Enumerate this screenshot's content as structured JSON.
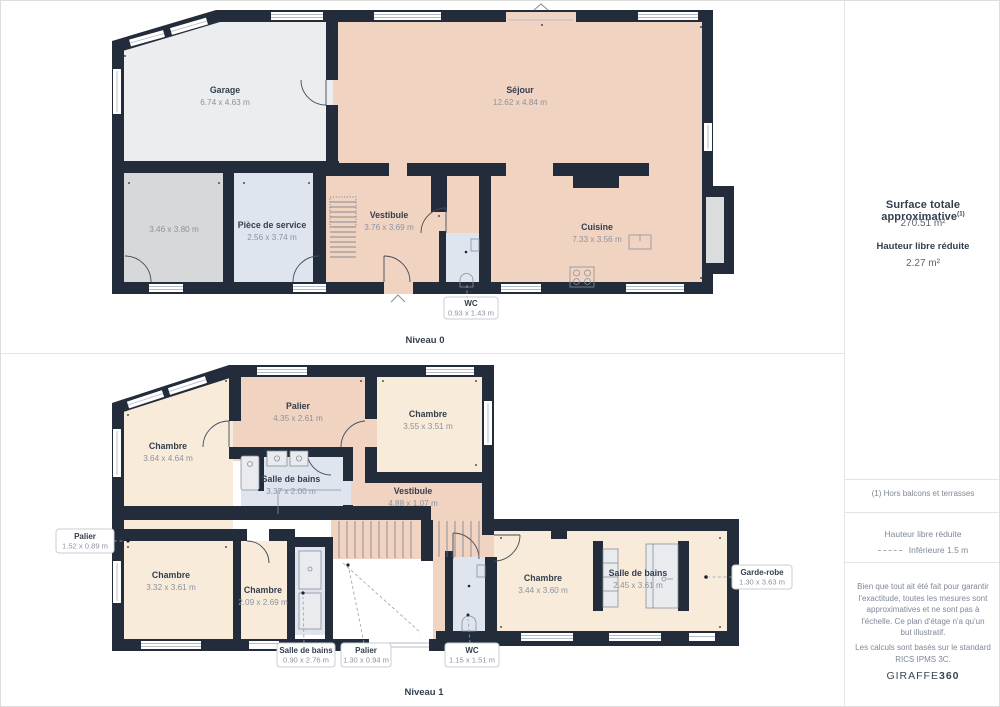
{
  "sidebar": {
    "surface_title": "Surface totale approximative",
    "surface_sup": "(1)",
    "surface_value": "270.51 m²",
    "height_title": "Hauteur libre réduite",
    "height_value": "2.27 m²",
    "footnote": "(1) Hors balcons et terrasses",
    "legend_title": "Hauteur libre réduite",
    "legend_item": "Inférieure 1.5 m",
    "disclaimer1": "Bien que tout ait été fait pour garantir l'exactitude, toutes les mesures sont approximatives et ne sont pas à l'échelle. Ce plan d'étage n'a qu'un but illustratif.",
    "disclaimer2": "Les calculs sont basés sur le standard RICS IPMS 3C.",
    "brand_name": "GIRAFFE",
    "brand_suffix": "360"
  },
  "floor0": {
    "title": "Niveau 0",
    "rooms": {
      "garage": {
        "name": "Garage",
        "dims": "6.74 x 4.63 m"
      },
      "sejour": {
        "name": "Séjour",
        "dims": "12.62 x 4.84 m"
      },
      "storage": {
        "name": "",
        "dims": "3.46 x 3.80 m"
      },
      "piece_de_service": {
        "name": "Pièce de service",
        "dims": "2.56 x 3.74 m"
      },
      "vestibule": {
        "name": "Vestibule",
        "dims": "3.76 x 3.69 m"
      },
      "cuisine": {
        "name": "Cuisine",
        "dims": "7.33 x 3.56 m"
      },
      "wc": {
        "name": "WC",
        "dims": "0.93 x 1.43 m"
      }
    }
  },
  "floor1": {
    "title": "Niveau 1",
    "rooms": {
      "chambre_nw": {
        "name": "Chambre",
        "dims": "3.64 x 4.64 m"
      },
      "palier_haut": {
        "name": "Palier",
        "dims": "4.35 x 2.61 m"
      },
      "chambre_ne": {
        "name": "Chambre",
        "dims": "3.55 x 3.51 m"
      },
      "salle_de_bains_haut": {
        "name": "Salle de bains",
        "dims": "3.37 x 2.00 m"
      },
      "vestibule": {
        "name": "Vestibule",
        "dims": "4.88 x 1.07 m"
      },
      "palier_gauche": {
        "name": "Palier",
        "dims": "1.52 x 0.89 m"
      },
      "chambre_sw": {
        "name": "Chambre",
        "dims": "3.32 x 3.61 m"
      },
      "chambre_sm": {
        "name": "Chambre",
        "dims": "2.09 x 2.69 m"
      },
      "salle_de_bains_bas": {
        "name": "Salle de bains",
        "dims": "0.90 x 2.76 m"
      },
      "palier_bas": {
        "name": "Palier",
        "dims": "1.30 x 0.94 m"
      },
      "wc": {
        "name": "WC",
        "dims": "1.15 x 1.51 m"
      },
      "chambre_se": {
        "name": "Chambre",
        "dims": "3.44 x 3.60 m"
      },
      "salle_de_bains_est": {
        "name": "Salle de bains",
        "dims": "2.45 x 3.61 m"
      },
      "garde_robe": {
        "name": "Garde-robe",
        "dims": "1.30 x 3.63 m"
      }
    }
  },
  "colors": {
    "wall": "#232c3a",
    "peach": "#f1d3c2",
    "cream": "#f8ebd9",
    "bath": "#dfe5ef",
    "garage": "#ebedee",
    "storage": "#d6d8d9",
    "ink": "#333e4e",
    "muted": "#8b93a2",
    "divider": "#e4e4e6"
  }
}
